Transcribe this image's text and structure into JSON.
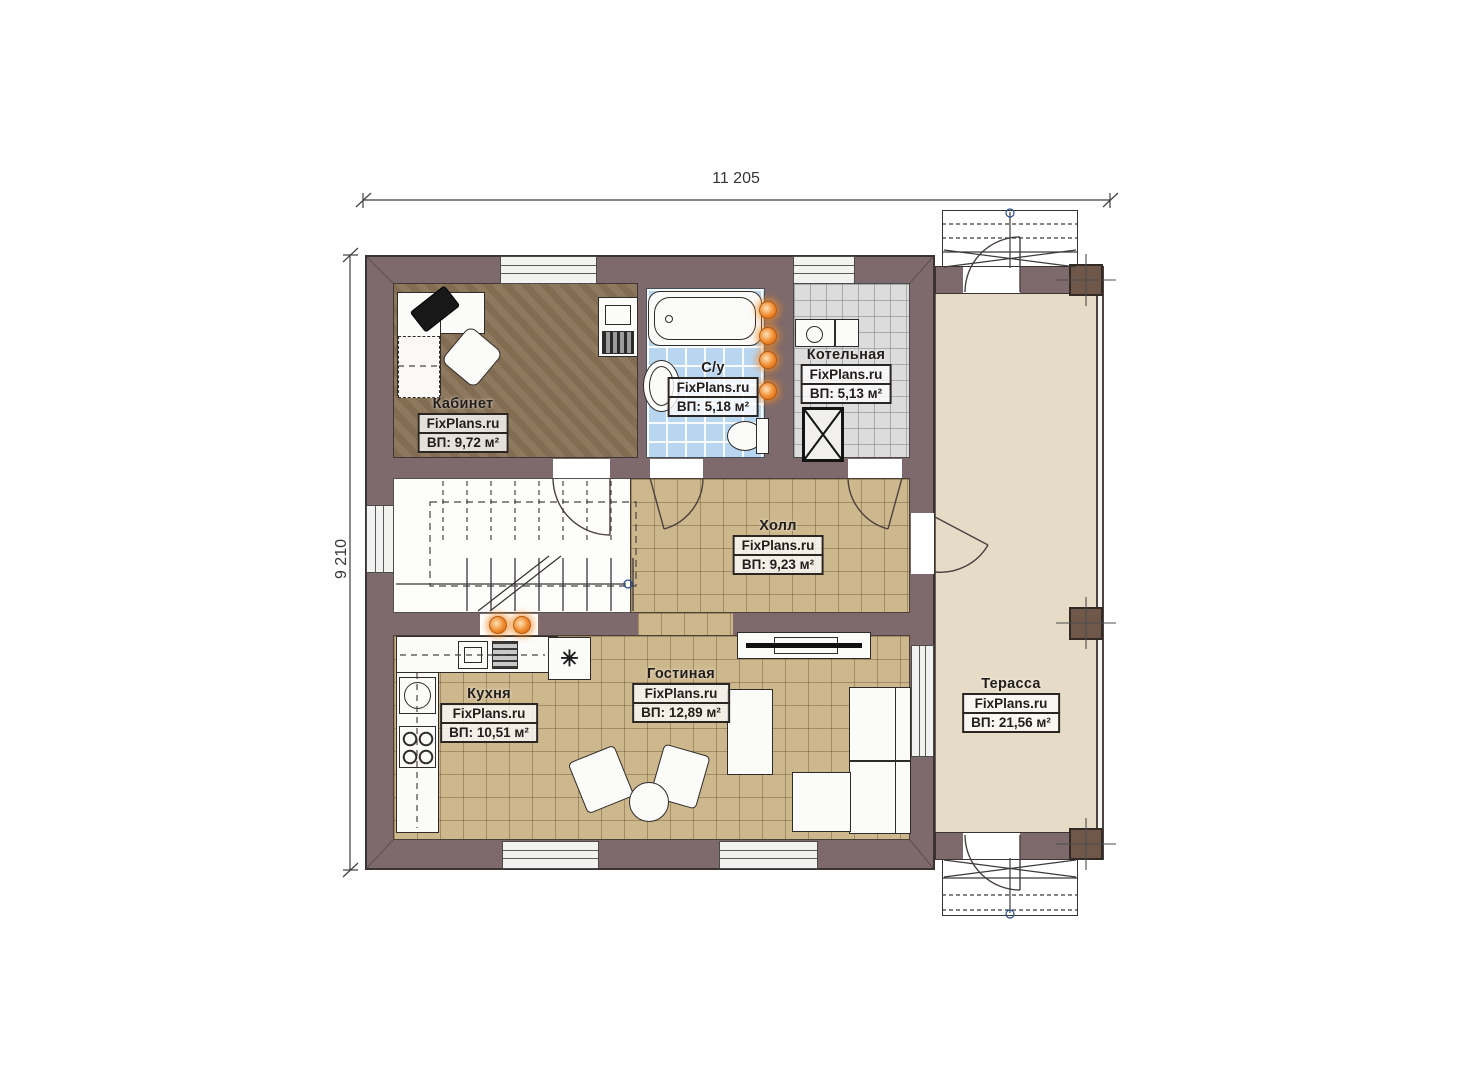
{
  "dimensions": {
    "top": "11 205",
    "left": "9 210"
  },
  "rooms": [
    {
      "key": "office",
      "name": "Кабинет",
      "watermark": "FixPlans.ru",
      "area": "ВП: 9,72 м²"
    },
    {
      "key": "bathroom",
      "name": "С/у",
      "watermark": "FixPlans.ru",
      "area": "ВП: 5,18 м²"
    },
    {
      "key": "boiler",
      "name": "Котельная",
      "watermark": "FixPlans.ru",
      "area": "ВП: 5,13 м²"
    },
    {
      "key": "hall",
      "name": "Холл",
      "watermark": "FixPlans.ru",
      "area": "ВП: 9,23 м²"
    },
    {
      "key": "kitchen",
      "name": "Кухня",
      "watermark": "FixPlans.ru",
      "area": "ВП: 10,51 м²"
    },
    {
      "key": "living",
      "name": "Гостиная",
      "watermark": "FixPlans.ru",
      "area": "ВП: 12,89 м²"
    },
    {
      "key": "terrace",
      "name": "Терасса",
      "watermark": "FixPlans.ru",
      "area": "ВП: 21,56 м²"
    }
  ],
  "icons": {
    "fridge_glyph": "✳"
  },
  "colors": {
    "wall": "#7e6a6c",
    "office_floor": "#8a7457",
    "tile_tan": "#cdb78c",
    "tile_blue": "#b9d6f0",
    "tile_gray": "#dcdcdc",
    "terrace_floor": "#e6dbc6",
    "column": "#6f5849",
    "radiator": "#ef8a2e"
  }
}
